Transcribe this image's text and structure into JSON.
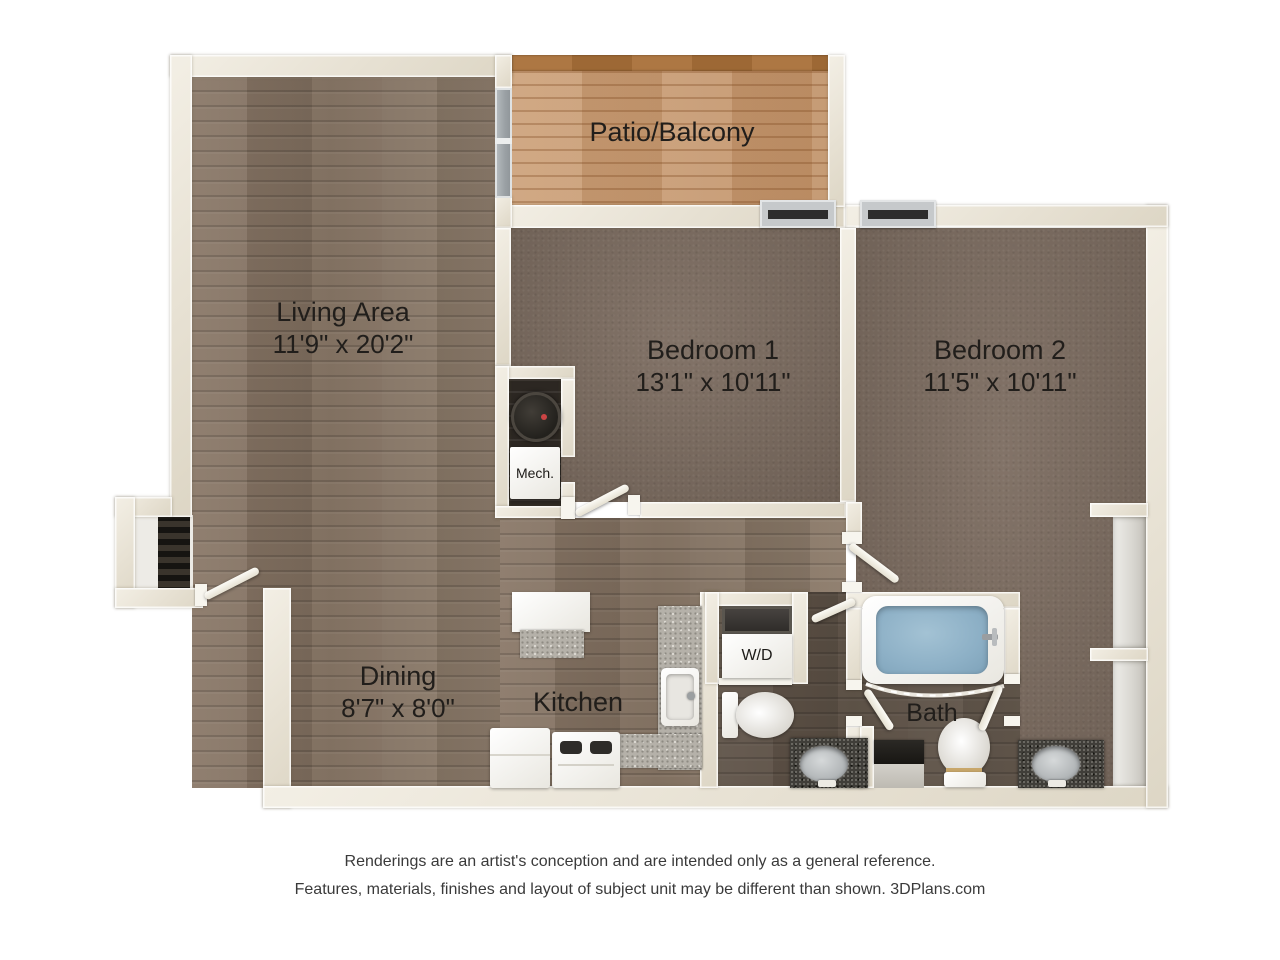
{
  "rooms": {
    "patio": {
      "label": "Patio/Balcony"
    },
    "living": {
      "label": "Living Area",
      "dims": "11'9\" x 20'2\""
    },
    "bedroom1": {
      "label": "Bedroom 1",
      "dims": "13'1\" x 10'11\""
    },
    "bedroom2": {
      "label": "Bedroom 2",
      "dims": "11'5\" x 10'11\""
    },
    "dining": {
      "label": "Dining",
      "dims": "8'7\" x 8'0\""
    },
    "kitchen": {
      "label": "Kitchen"
    },
    "bath": {
      "label": "Bath"
    },
    "mech_closet": {
      "label": "Mech."
    },
    "laundry": {
      "label": "W/D"
    }
  },
  "footer": {
    "line1": "Renderings are an artist's conception and are intended only as a general reference.",
    "line2": "Features, materials, finishes and layout of subject unit may be different than shown. 3DPlans.com"
  },
  "colors": {
    "wall": "#e9e4d8",
    "wood_floor": "#867463",
    "patio_deck": "#c89d76",
    "patio_rail": "#a8743f",
    "carpet": "#7c6c60",
    "wet_floor": "#61544a",
    "granite_dark": "#403e39",
    "granite_light": "#b5b1a9",
    "tub_water": "#8db0c6",
    "window_frame": "#c6c9cb",
    "label_text": "#211e1b"
  }
}
